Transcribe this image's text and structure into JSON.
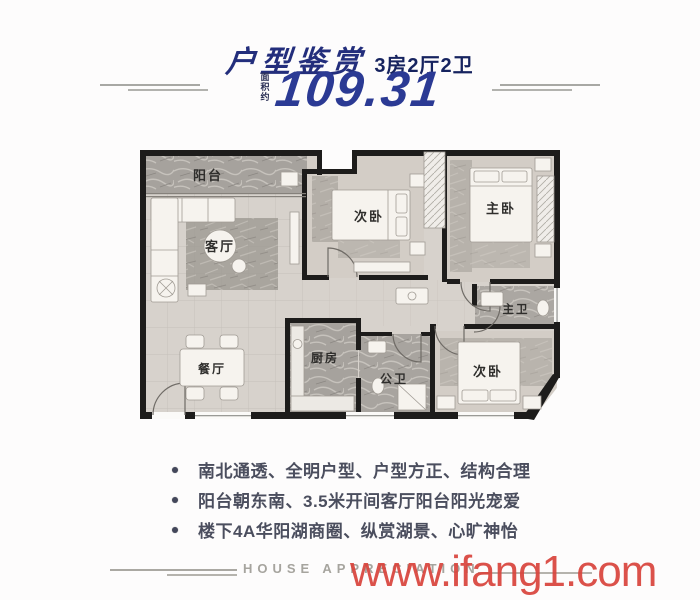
{
  "header": {
    "title": "户型鉴赏",
    "subtitle": "3房2厅2卫",
    "area_prefix": "面积约",
    "area_value": "109.31"
  },
  "floorplan": {
    "rooms": {
      "balcony": "阳台",
      "living_room": "客厅",
      "dining_room": "餐厅",
      "bedroom_mid": "次卧",
      "master_bedroom": "主卧",
      "master_bath": "主卫",
      "bedroom_corner": "次卧",
      "kitchen": "厨房",
      "guest_bath": "公卫"
    }
  },
  "features": {
    "items": [
      "南北通透、全明户型、户型方正、结构合理",
      "阳台朝东南、3.5米开间客厅阳台阳光宠爱",
      "楼下4A华阳湖商圈、纵赏湖景、心旷神怡"
    ]
  },
  "footer": {
    "caption": "HOUSE APPRECIATION",
    "watermark": "www.ifang1.com"
  },
  "colors": {
    "title_navy": "#232e7c",
    "number_navy": "#2b3a94",
    "feature_text": "#4b4e5e",
    "watermark_red": "#d9453d",
    "wall_black": "#1d1c1b"
  }
}
